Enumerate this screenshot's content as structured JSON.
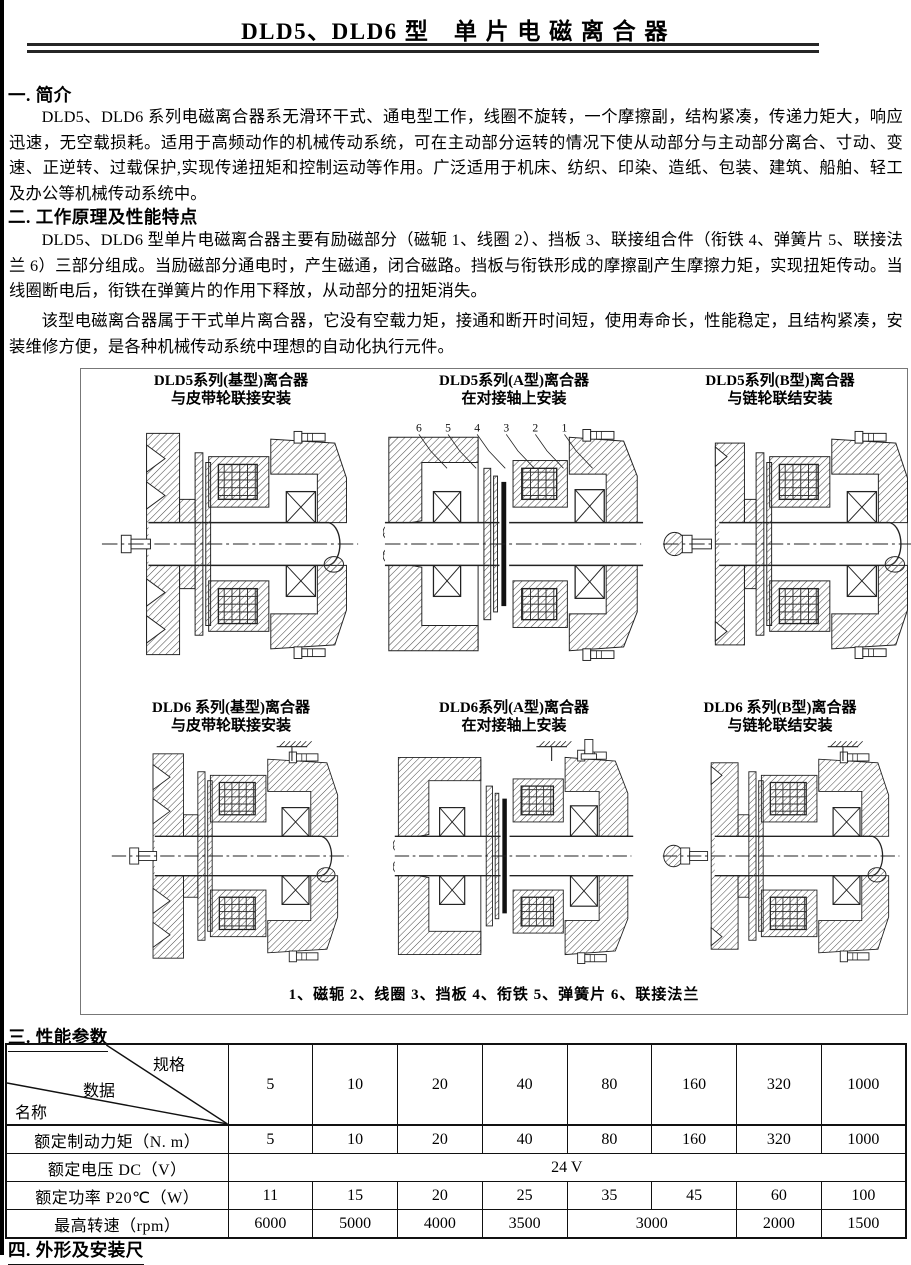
{
  "page": {
    "title": "DLD5、DLD6 型　单 片 电 磁 离 合 器"
  },
  "sections": {
    "s1": {
      "heading": "一. 简介",
      "p1": "DLD5、DLD6 系列电磁离合器系无滑环干式、通电型工作，线圈不旋转，一个摩擦副，结构紧凑，传递力矩大，响应迅速，无空载损耗。适用于高频动作的机械传动系统，可在主动部分运转的情况下使从动部分与主动部分离合、寸动、变速、正逆转、过载保护,实现传递扭矩和控制运动等作用。广泛适用于机床、纺织、印染、造纸、包装、建筑、船舶、轻工及办公等机械传动系统中。"
    },
    "s2": {
      "heading": "二. 工作原理及性能特点",
      "p1": "DLD5、DLD6 型单片电磁离合器主要有励磁部分（磁轭 1、线圈 2）、挡板 3、联接组合件（衔铁 4、弹簧片 5、联接法兰 6）三部分组成。当励磁部分通电时，产生磁通，闭合磁路。挡板与衔铁形成的摩擦副产生摩擦力矩，实现扭矩传动。当线圈断电后，衔铁在弹簧片的作用下释放，从动部分的扭矩消失。",
      "p2": "该型电磁离合器属于干式单片离合器，它没有空载力矩，接通和断开时间短，使用寿命长，性能稳定，且结构紧凑，安装维修方便，是各种机械传动系统中理想的自动化执行元件。"
    },
    "s3": {
      "heading": "三. 性能参数"
    },
    "s4": {
      "heading": "四. 外形及安装尺"
    }
  },
  "figures": {
    "captions": [
      {
        "line1": "DLD5系列(基型)离合器",
        "line2": "与皮带轮联接安装"
      },
      {
        "line1": "DLD5系列(A型)离合器",
        "line2": "在对接轴上安装"
      },
      {
        "line1": "DLD5系列(B型)离合器",
        "line2": "与链轮联结安装"
      },
      {
        "line1": "DLD6 系列(基型)离合器",
        "line2": "与皮带轮联接安装"
      },
      {
        "line1": "DLD6系列(A型)离合器",
        "line2": "在对接轴上安装"
      },
      {
        "line1": "DLD6 系列(B型)离合器",
        "line2": "与链轮联结安装"
      }
    ],
    "callouts": [
      "6",
      "5",
      "4",
      "3",
      "2",
      "1"
    ],
    "legend": "1、磁轭  2、线圈  3、挡板  4、衔铁  5、弹簧片  6、联接法兰"
  },
  "table": {
    "corner": {
      "spec": "规格",
      "data": "数据",
      "name": "名称"
    },
    "spec_columns": [
      "5",
      "10",
      "20",
      "40",
      "80",
      "160",
      "320",
      "1000"
    ],
    "rows": [
      {
        "label": "额定制动力矩（N. m）",
        "values": [
          "5",
          "10",
          "20",
          "40",
          "80",
          "160",
          "320",
          "1000"
        ]
      },
      {
        "label": "额定电压 DC（V）",
        "span_value": "24 V"
      },
      {
        "label": "额定功率 P20℃（W）",
        "values": [
          "11",
          "15",
          "20",
          "25",
          "35",
          "45",
          "60",
          "100"
        ]
      },
      {
        "label": "最高转速（rpm）",
        "values": [
          "6000",
          "5000",
          "4000",
          "3500",
          "3000",
          "2000",
          "1500"
        ]
      }
    ]
  }
}
